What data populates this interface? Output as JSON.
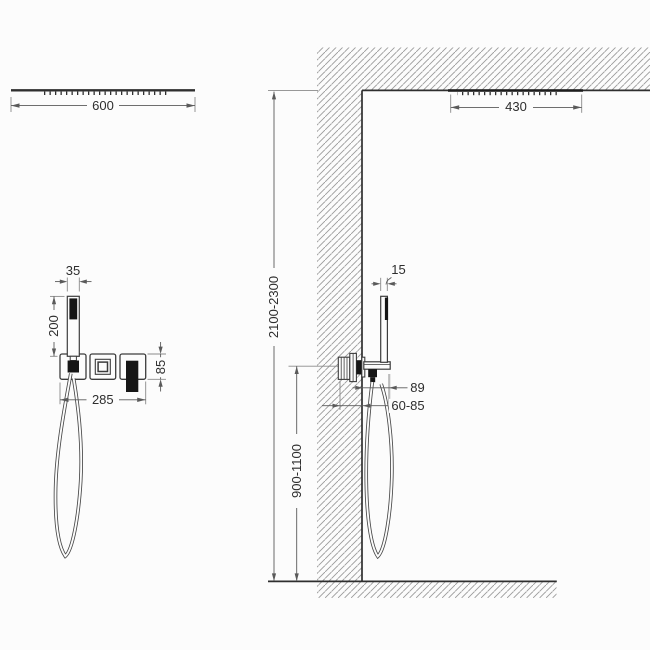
{
  "drawing": {
    "type": "shower-system-installation-dimension-diagram",
    "colors": {
      "background": "#fcfcfc",
      "line": "#3c3c3c",
      "dimension_line": "#5a5a5a",
      "hatch": "#9a9a9a",
      "dark_fill": "#161616",
      "text": "#2e2e2e"
    },
    "front_view": {
      "overhead_shower_width": "600",
      "hand_shower_width": "35",
      "hand_shower_length": "200",
      "trim_plate_span": "285",
      "trim_plate_height": "85"
    },
    "side_view": {
      "overhead_shower_depth": "430",
      "hand_shower_depth": "15",
      "ceiling_height_range": "2100-2300",
      "valve_height_range": "900-1100",
      "bracket_projection": "89",
      "rough_in_depth": "60-85"
    }
  }
}
